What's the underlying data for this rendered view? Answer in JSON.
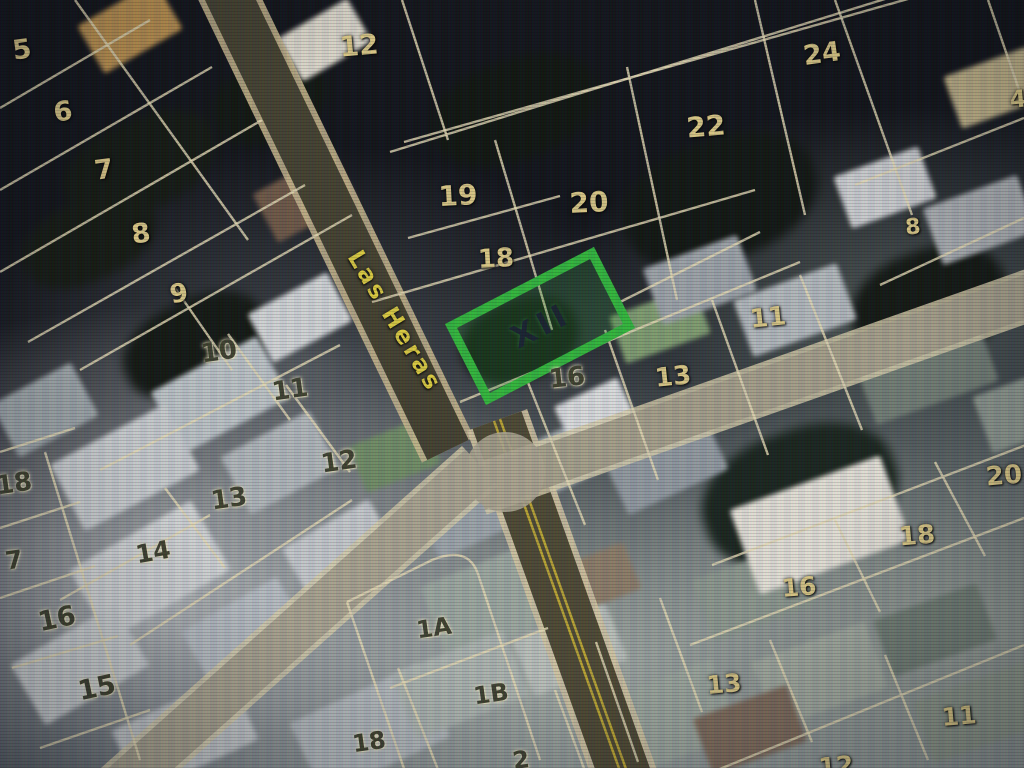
{
  "map": {
    "street_name": "Las Heras",
    "highlight": {
      "label": "XII",
      "color": "#2fb43a"
    },
    "colors": {
      "street_text": "#d8c83e",
      "parcel_label_light": "#d6c483",
      "parcel_label_dark": "#3c3e2c",
      "parcel_line": "#e0d6b2"
    },
    "parcel_labels": [
      {
        "text": "5",
        "x": 22,
        "y": 50,
        "tone": "light",
        "size": 27,
        "rot": -8
      },
      {
        "text": "6",
        "x": 63,
        "y": 112,
        "tone": "light",
        "size": 27,
        "rot": -8
      },
      {
        "text": "7",
        "x": 104,
        "y": 170,
        "tone": "light",
        "size": 27,
        "rot": -8
      },
      {
        "text": "8",
        "x": 141,
        "y": 234,
        "tone": "light",
        "size": 27,
        "rot": -8
      },
      {
        "text": "12",
        "x": 359,
        "y": 46,
        "tone": "light",
        "size": 28,
        "rot": -5
      },
      {
        "text": "19",
        "x": 458,
        "y": 196,
        "tone": "light",
        "size": 28,
        "rot": -3
      },
      {
        "text": "20",
        "x": 589,
        "y": 203,
        "tone": "light",
        "size": 28,
        "rot": -3
      },
      {
        "text": "18",
        "x": 496,
        "y": 259,
        "tone": "light",
        "size": 26,
        "rot": -3
      },
      {
        "text": "22",
        "x": 706,
        "y": 127,
        "tone": "light",
        "size": 28,
        "rot": -5
      },
      {
        "text": "24",
        "x": 822,
        "y": 54,
        "tone": "light",
        "size": 27,
        "rot": -8
      },
      {
        "text": "8",
        "x": 913,
        "y": 228,
        "tone": "light",
        "size": 22,
        "rot": -5
      },
      {
        "text": "4",
        "x": 1018,
        "y": 99,
        "tone": "light",
        "size": 24,
        "rot": -5
      },
      {
        "text": "9",
        "x": 179,
        "y": 294,
        "tone": "light",
        "size": 26,
        "rot": -10
      },
      {
        "text": "10",
        "x": 219,
        "y": 352,
        "tone": "dark",
        "size": 26,
        "rot": -8
      },
      {
        "text": "11",
        "x": 290,
        "y": 390,
        "tone": "dark",
        "size": 26,
        "rot": -8
      },
      {
        "text": "12",
        "x": 339,
        "y": 462,
        "tone": "dark",
        "size": 26,
        "rot": -8
      },
      {
        "text": "13",
        "x": 229,
        "y": 499,
        "tone": "dark",
        "size": 26,
        "rot": -8
      },
      {
        "text": "14",
        "x": 153,
        "y": 552,
        "tone": "dark",
        "size": 25,
        "rot": -10
      },
      {
        "text": "18",
        "x": 14,
        "y": 484,
        "tone": "dark",
        "size": 26,
        "rot": -8
      },
      {
        "text": "7",
        "x": 14,
        "y": 560,
        "tone": "dark",
        "size": 25,
        "rot": -8
      },
      {
        "text": "16",
        "x": 57,
        "y": 619,
        "tone": "dark",
        "size": 27,
        "rot": -12
      },
      {
        "text": "15",
        "x": 97,
        "y": 688,
        "tone": "dark",
        "size": 27,
        "rot": -12
      },
      {
        "text": "16",
        "x": 567,
        "y": 378,
        "tone": "dark",
        "size": 26,
        "rot": -6
      },
      {
        "text": "13",
        "x": 673,
        "y": 377,
        "tone": "light",
        "size": 26,
        "rot": -6
      },
      {
        "text": "11",
        "x": 768,
        "y": 318,
        "tone": "light",
        "size": 26,
        "rot": -6
      },
      {
        "text": "20",
        "x": 1004,
        "y": 476,
        "tone": "light",
        "size": 26,
        "rot": -5
      },
      {
        "text": "18",
        "x": 917,
        "y": 536,
        "tone": "light",
        "size": 26,
        "rot": -5
      },
      {
        "text": "16",
        "x": 799,
        "y": 587,
        "tone": "light",
        "size": 25,
        "rot": -5
      },
      {
        "text": "13",
        "x": 724,
        "y": 684,
        "tone": "light",
        "size": 25,
        "rot": -5
      },
      {
        "text": "11",
        "x": 959,
        "y": 716,
        "tone": "light",
        "size": 25,
        "rot": -5
      },
      {
        "text": "12",
        "x": 836,
        "y": 766,
        "tone": "light",
        "size": 25,
        "rot": -5
      },
      {
        "text": "1A",
        "x": 434,
        "y": 628,
        "tone": "dark",
        "size": 24,
        "rot": -8
      },
      {
        "text": "1B",
        "x": 491,
        "y": 694,
        "tone": "dark",
        "size": 24,
        "rot": -8
      },
      {
        "text": "18",
        "x": 369,
        "y": 742,
        "tone": "dark",
        "size": 24,
        "rot": -8
      },
      {
        "text": "2",
        "x": 521,
        "y": 760,
        "tone": "dark",
        "size": 24,
        "rot": -8
      }
    ]
  }
}
